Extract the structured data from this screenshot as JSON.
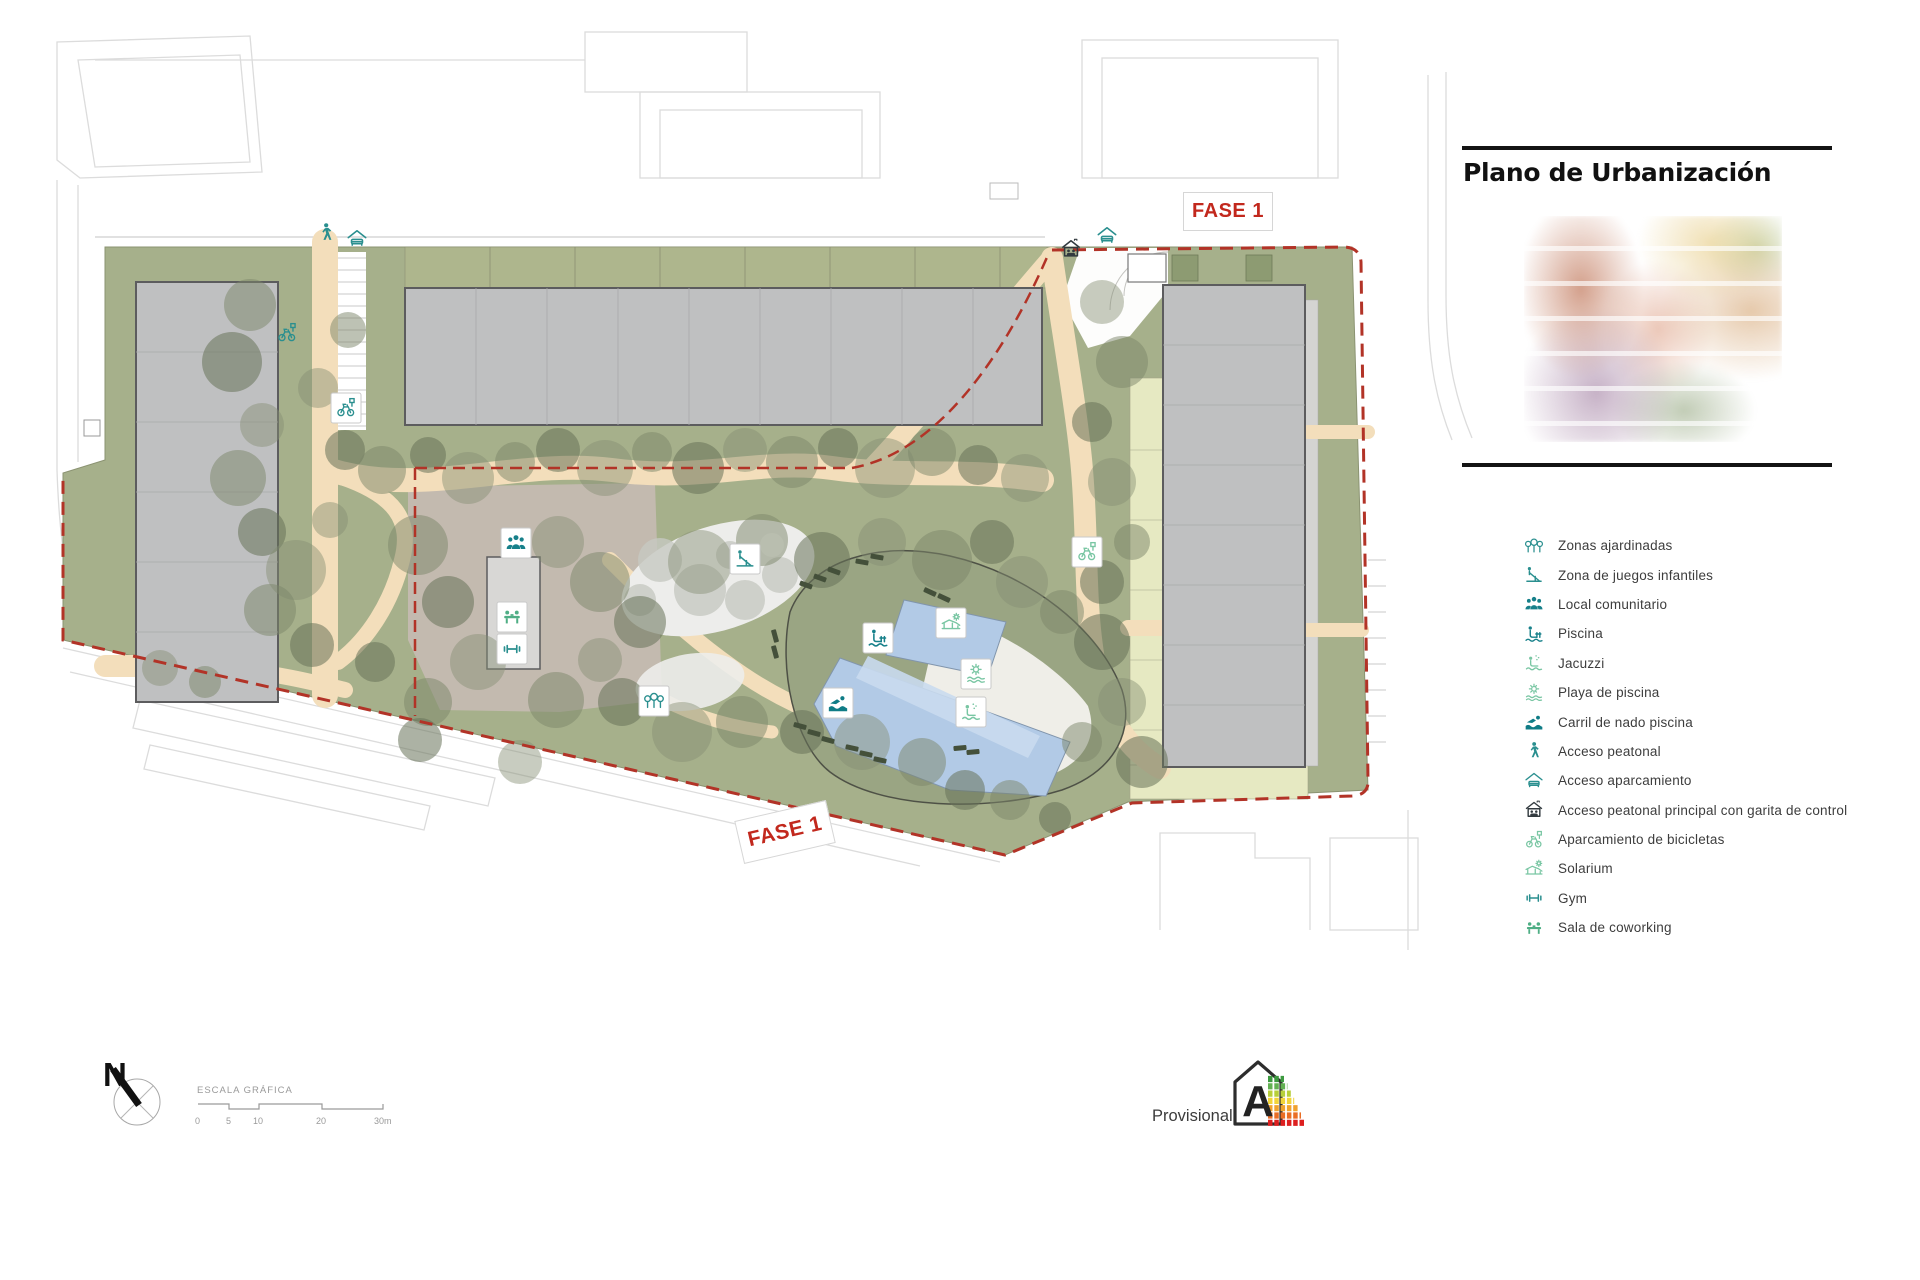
{
  "title": "Plano de Urbanización",
  "phase_labels": {
    "top": "FASE 1",
    "bottom": "FASE 1"
  },
  "legend": {
    "items": [
      {
        "label": "Zonas ajardinadas",
        "icon": "trees-icon",
        "color": "#2a8f8f"
      },
      {
        "label": "Zona de juegos infantiles",
        "icon": "playground-slide-icon",
        "color": "#2a8f8f"
      },
      {
        "label": "Local comunitario",
        "icon": "community-people-icon",
        "color": "#17808a"
      },
      {
        "label": "Piscina",
        "icon": "pool-person-icon",
        "color": "#17808a"
      },
      {
        "label": "Jacuzzi",
        "icon": "jacuzzi-icon",
        "color": "#79c6a3"
      },
      {
        "label": "Playa de piscina",
        "icon": "sun-waves-icon",
        "color": "#79c6a3"
      },
      {
        "label": "Carril de nado piscina",
        "icon": "swimmer-icon",
        "color": "#0f7c86"
      },
      {
        "label": "Acceso peatonal",
        "icon": "pedestrian-icon",
        "color": "#2a8f8f"
      },
      {
        "label": "Acceso aparcamiento",
        "icon": "car-canopy-icon",
        "color": "#2a8f8f"
      },
      {
        "label": "Acceso peatonal principal con garita de control",
        "icon": "guard-house-icon",
        "color": "#323a3f"
      },
      {
        "label": "Aparcamiento de bicicletas",
        "icon": "bicycle-icon",
        "color": "#79c6a3"
      },
      {
        "label": "Solarium",
        "icon": "sun-lounger-icon",
        "color": "#79c6a3"
      },
      {
        "label": "Gym",
        "icon": "dumbbell-icon",
        "color": "#2a8f8f"
      },
      {
        "label": "Sala de coworking",
        "icon": "coworking-icon",
        "color": "#4fae85"
      }
    ]
  },
  "compass": {
    "north_label": "N"
  },
  "scale_bar": {
    "caption": "ESCALA GRÁFICA",
    "ticks": [
      "0",
      "5",
      "10",
      "20",
      "30m"
    ]
  },
  "energy_label": {
    "status_text": "Provisional",
    "rating": "A",
    "bar_colors": [
      "#3d9a40",
      "#62b152",
      "#b7cf3a",
      "#f2d43a",
      "#f0a22e",
      "#ea6d24",
      "#dd1f1f"
    ]
  },
  "colors": {
    "site_green": "#a6b08b",
    "path_tan": "#f3debb",
    "building_gray": "#bfc0c1",
    "pool_blue": "#b2cae6",
    "boundary_red": "#b23327",
    "phase_red": "#c2281d",
    "icon_teal": "#2a8f8f",
    "icon_light_green": "#79c6a3"
  }
}
